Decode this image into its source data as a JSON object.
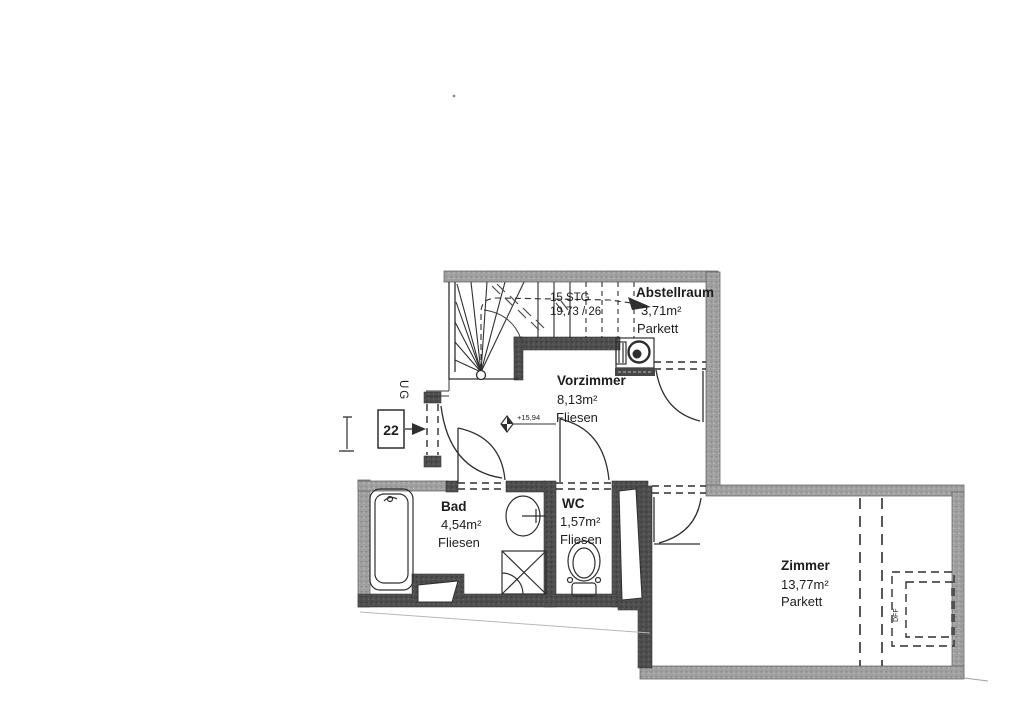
{
  "plan": {
    "unit_box_label": "22",
    "level_label": "UG",
    "elevation_label": "+15,94",
    "stairs": {
      "count_label": "15 STG",
      "dim_label": "19,73 / 26"
    },
    "roof_window_label": "DFF",
    "rooms": [
      {
        "name": "Vorzimmer",
        "area": "8,13m²",
        "floor": "Fliesen"
      },
      {
        "name": "Abstellraum",
        "area": "3,71m²",
        "floor": "Parkett"
      },
      {
        "name": "Bad",
        "area": "4,54m²",
        "floor": "Fliesen"
      },
      {
        "name": "WC",
        "area": "1,57m²",
        "floor": "Fliesen"
      },
      {
        "name": "Zimmer",
        "area": "13,77m²",
        "floor": "Parkett"
      }
    ]
  },
  "colors": {
    "background": "#ffffff",
    "wall_outer": "#9b9b9b",
    "wall_inner": "#4a4a4a",
    "line": "#2f2f2f"
  }
}
